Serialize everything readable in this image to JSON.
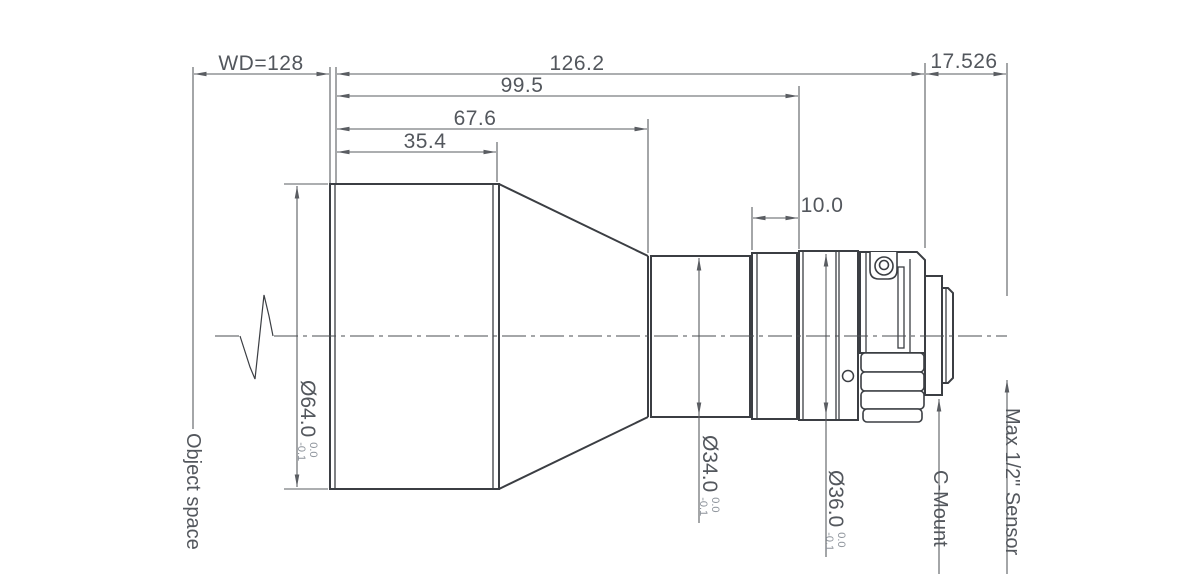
{
  "drawing": {
    "kind": "lens-mechanical-drawing",
    "colors": {
      "body_line": "#3b3e43",
      "dim_line": "#5a5d62",
      "text": "#53575d",
      "tolerance_text": "#8d939b",
      "background": "#ffffff"
    },
    "horizontal_dimensions": {
      "working_distance": "WD=128",
      "overall_length": "126.2",
      "length_mid": "99.5",
      "length_front_group": "67.6",
      "length_front_barrel": "35.4",
      "flange_distance": "17.526",
      "focus_section": "10.0"
    },
    "diameter_dimensions": {
      "front": {
        "label": "Ø64.0",
        "tol_upper": "0.0",
        "tol_lower": "-0.1"
      },
      "mid": {
        "label": "Ø34.0",
        "tol_upper": "0.0",
        "tol_lower": "-0.1"
      },
      "rear": {
        "label": "Ø36.0",
        "tol_upper": "0.0",
        "tol_lower": "-0.1"
      }
    },
    "annotations": {
      "object_space": "Object space",
      "c_mount": "C-Mount",
      "sensor": "Max 1/2\" Sensor"
    }
  }
}
